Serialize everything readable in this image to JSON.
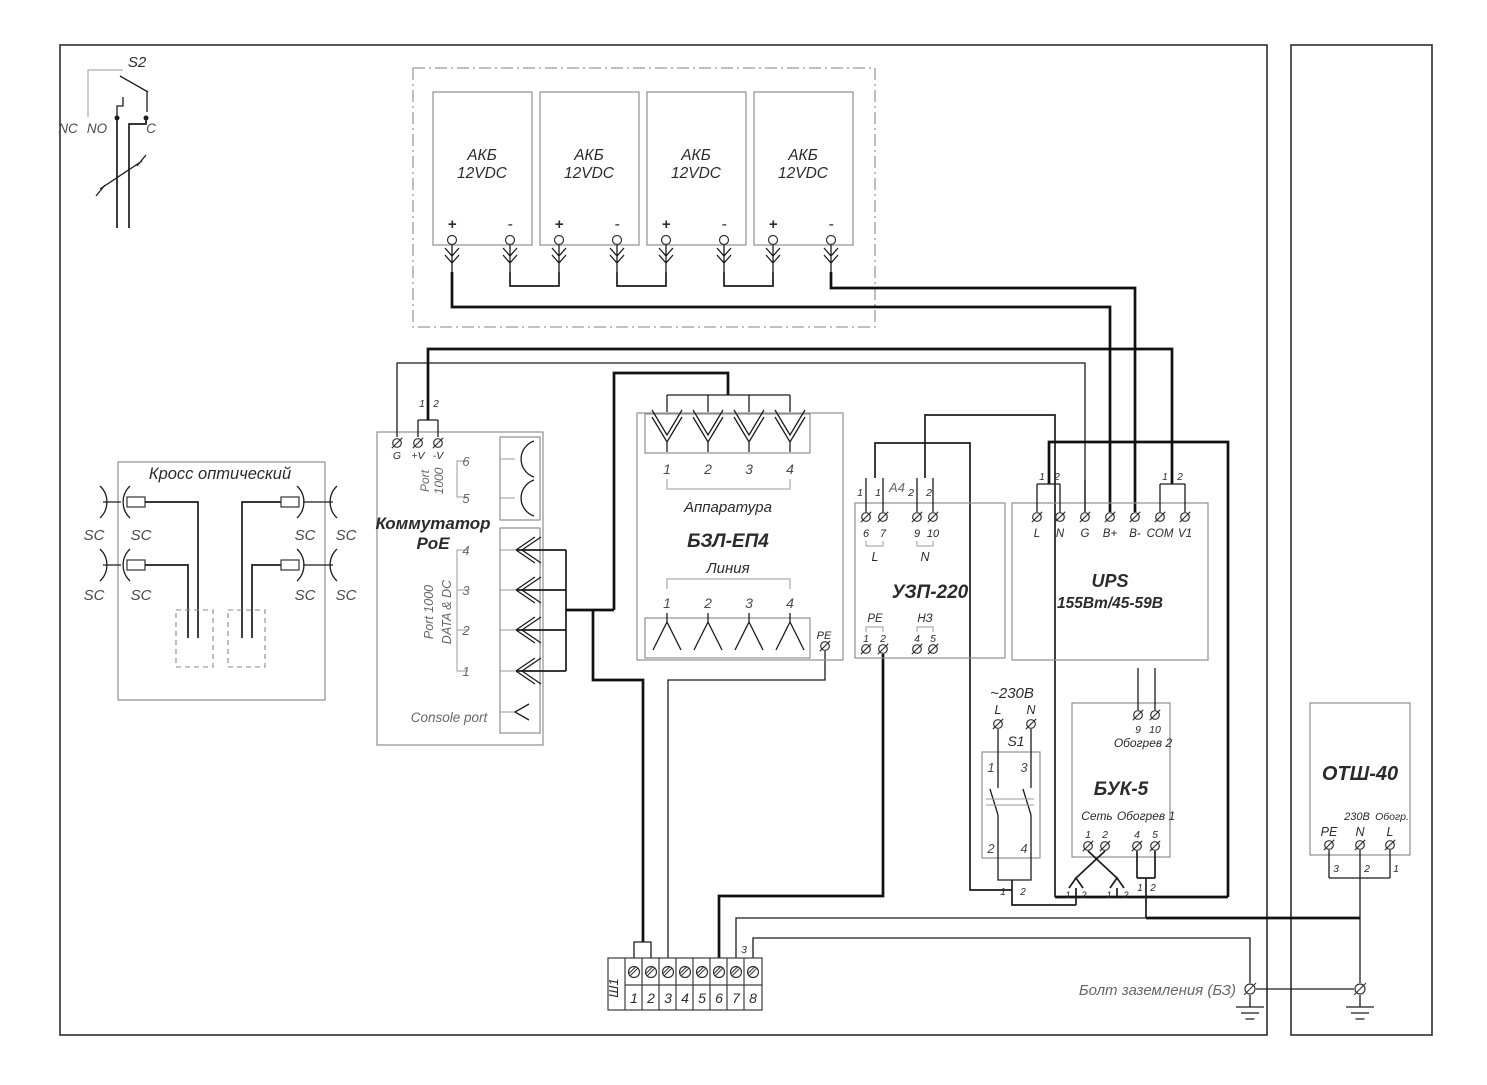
{
  "s2": {
    "name": "S2",
    "nc": "NC",
    "no": "NO",
    "c": "C"
  },
  "bat": {
    "plus": "+",
    "minus": "-",
    "units": [
      {
        "l1": "АКБ",
        "l2": "12VDC"
      },
      {
        "l1": "АКБ",
        "l2": "12VDC"
      },
      {
        "l1": "АКБ",
        "l2": "12VDC"
      },
      {
        "l1": "АКБ",
        "l2": "12VDC"
      }
    ]
  },
  "cross": {
    "title": "Кросс оптический",
    "sc": "SC"
  },
  "poe": {
    "title1": "Коммутатор",
    "title2": "PoE",
    "g": "G",
    "vplus": "+V",
    "vminus": "-V",
    "w1": "1",
    "w2": "2",
    "port_a": "Port",
    "port_b": "1000",
    "portd_a": "Port 1000",
    "portd_b": "DATA & DC",
    "p6": "6",
    "p5": "5",
    "p4": "4",
    "p3": "3",
    "p2": "2",
    "p1": "1",
    "console": "Console port"
  },
  "bzl": {
    "title": "БЗЛ-ЕП4",
    "app": "Аппаратура",
    "lin": "Линия",
    "n": [
      "1",
      "2",
      "3",
      "4"
    ],
    "pe": "PE"
  },
  "uzp": {
    "title": "УЗП-220",
    "w1": "1",
    "w2": "2",
    "cable": "А4",
    "t6": "6",
    "t7": "7",
    "t9": "9",
    "t10": "10",
    "L": "L",
    "N": "N",
    "pe": "PE",
    "nz": "НЗ",
    "b1": "1",
    "b2": "2",
    "b4": "4",
    "b5": "5"
  },
  "ups": {
    "title": "UPS",
    "subtitle": "155Вт/45-59В",
    "w1": "1",
    "w2": "2",
    "t": [
      "L",
      "N",
      "G",
      "B+",
      "B-",
      "COM",
      "V1"
    ]
  },
  "s1": {
    "volt": "~230В",
    "L": "L",
    "N": "N",
    "name": "S1",
    "c1": "1",
    "c3": "3",
    "c2": "2",
    "c4": "4",
    "w1": "1",
    "w2": "2"
  },
  "buk": {
    "title": "БУК-5",
    "heat2": "Обогрев 2",
    "t9": "9",
    "t10": "10",
    "net": "Сеть",
    "heat1": "Обогрев 1",
    "n1": "1",
    "n2": "2",
    "n4": "4",
    "n5": "5",
    "w1": "1",
    "w2": "2"
  },
  "otsh": {
    "title": "ОТШ-40",
    "v230": "230В",
    "heat": "Обогр.",
    "pe": "PE",
    "N": "N",
    "L": "L",
    "w3": "3",
    "w2": "2",
    "w1": "1"
  },
  "sh1": {
    "name": "Ш1",
    "t": [
      "1",
      "2",
      "3",
      "4",
      "5",
      "6",
      "7",
      "8"
    ],
    "w3": "3"
  },
  "gnd": {
    "label": "Болт заземления (БЗ)"
  }
}
